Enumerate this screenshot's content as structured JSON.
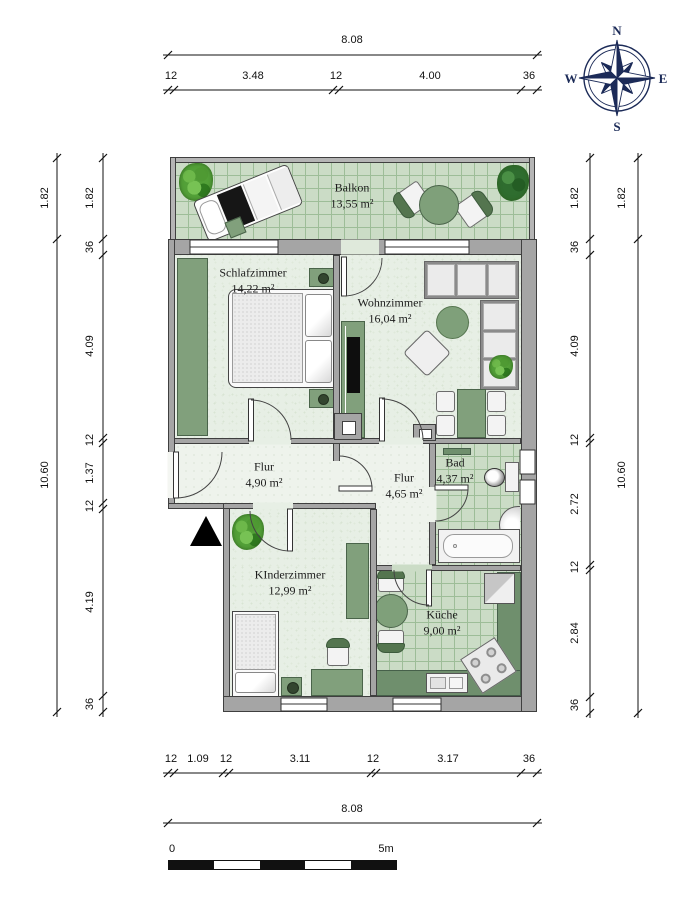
{
  "rooms": [
    {
      "id": "balkon",
      "name": "Balkon",
      "area": "13,55 m²"
    },
    {
      "id": "schlafzimmer",
      "name": "Schlafzimmer",
      "area": "14,22 m²"
    },
    {
      "id": "wohnzimmer",
      "name": "Wohnzimmer",
      "area": "16,04 m²"
    },
    {
      "id": "flur-links",
      "name": "Flur",
      "area": "4,90 m²"
    },
    {
      "id": "flur-rechts",
      "name": "Flur",
      "area": "4,65 m²"
    },
    {
      "id": "bad",
      "name": "Bad",
      "area": "4,37 m²"
    },
    {
      "id": "kinderzimmer",
      "name": "KInderzimmer",
      "area": "12,99 m²"
    },
    {
      "id": "kueche",
      "name": "Küche",
      "area": "9,00 m²"
    }
  ],
  "dimensions": {
    "top_total": "8.08",
    "top_segments": [
      "12",
      "3.48",
      "12",
      "4.00",
      "36"
    ],
    "bottom_segments": [
      "12",
      "1.09",
      "12",
      "3.11",
      "12",
      "3.17",
      "36"
    ],
    "bottom_total": "8.08",
    "left_outer": [
      "1.82",
      "10.60"
    ],
    "left_inner": [
      "1.82",
      "36",
      "4.09",
      "12",
      "1.37",
      "12",
      "4.19",
      "36"
    ],
    "right_inner": [
      "1.82",
      "36",
      "4.09",
      "12",
      "2.72",
      "12",
      "2.84",
      "36"
    ],
    "right_outer": [
      "1.82",
      "10.60"
    ]
  },
  "compass": {
    "n": "N",
    "e": "E",
    "s": "S",
    "w": "W"
  },
  "scale_bar": {
    "start": "0",
    "end": "5m"
  },
  "colors": {
    "wall": "#a5a5a5",
    "floor_soft": "#e7efe5",
    "floor_tile": "#cbdcc6",
    "furniture_green": "#81a07c",
    "counter_green": "#6f8f6d",
    "compass_navy": "#1c2b58"
  }
}
